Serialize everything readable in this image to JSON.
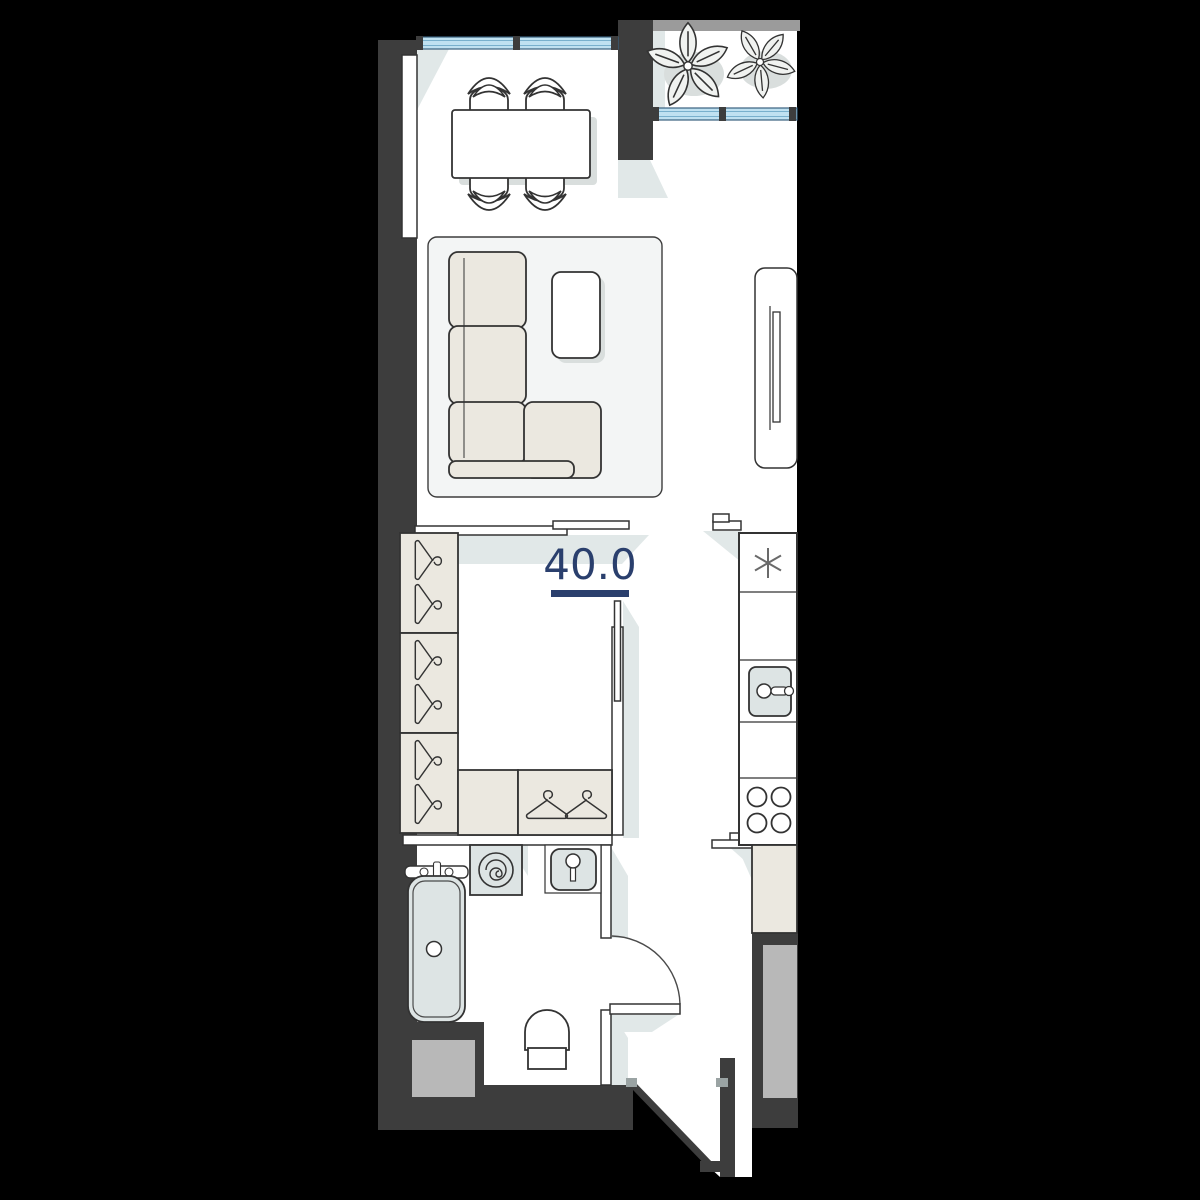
{
  "area_label": {
    "value": "40.0"
  },
  "colors": {
    "background": "#000000",
    "wall": "#3d3d3d",
    "floor": "#ffffff",
    "outline": "#333333",
    "shadow": "#e1e8e8",
    "furniture-shadow": "#d9dedd",
    "window-fill": "#bfe1f1",
    "window-frame": "#39607f",
    "window-line": "#78b0cd",
    "fixture": "#dde4e4",
    "furniture": "#ebe8e0",
    "rug": "#f3f5f5",
    "shaft": "#b8b8b8",
    "balcony-band": "#9b9b9b",
    "accent": "#2a3f6d",
    "door-mark": "#9aa3a3",
    "plant-fill": "#f0f2f0"
  }
}
